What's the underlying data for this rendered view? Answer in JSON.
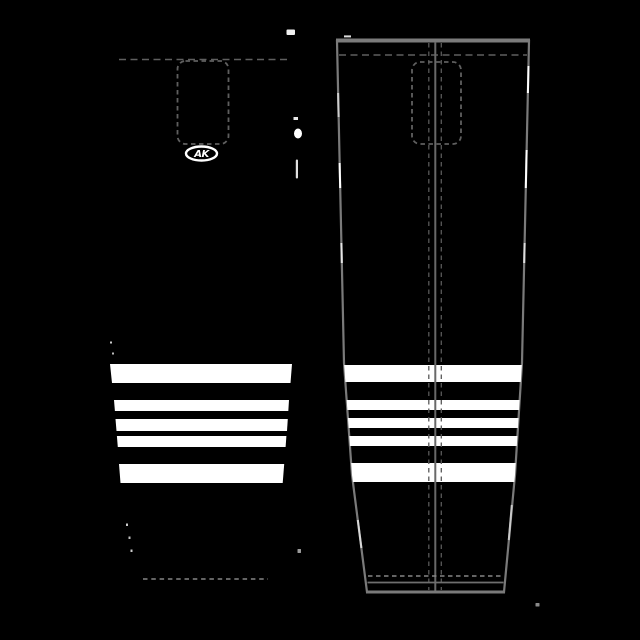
{
  "logo": {
    "text": "AK"
  },
  "colors": {
    "background": "#000000",
    "sock_fill": "#000000",
    "stripe": "#ffffff",
    "outline": "#7a7a7a",
    "top_border": "#7b7b7b",
    "solid_center": "#696969",
    "dash_dark": "#585858",
    "dash_mid": "#5f5f5f",
    "dash_light": "#868686",
    "hem_line": "#6f6f6f",
    "logo_ring": "#ffffff",
    "logo_fill": "#000000",
    "logo_text": "#ffffff"
  },
  "geometry": {
    "left_sock": {
      "body": "84,37 318,37 283.5,483 266,592 137,592 119.5,483",
      "stripes": [
        {
          "points": "110,364 292,364 290.5,383 112,383"
        },
        {
          "points": "114,400 289,400 288.3,411 114.9,411"
        },
        {
          "points": "115.5,419 287.8,419 287,431 116.5,431"
        },
        {
          "points": "116.9,436 286.4,436 285.6,447 117.8,447"
        },
        {
          "points": "119,464 284.2,464 282.7,483 120.5,483"
        }
      ],
      "top_dash_line": {
        "x1": 119,
        "y1": 59.5,
        "x2": 288,
        "y2": 59.5,
        "dash": "7,4.5",
        "w": 1.5
      },
      "bottom_dash_line": {
        "x1": 143,
        "y1": 579,
        "x2": 268,
        "y2": 579,
        "dash": "4.5,3.8",
        "w": 1.4
      },
      "pattern_rect": {
        "x": 177.5,
        "y": 61,
        "w": 51,
        "h": 83,
        "rx": 8,
        "dash": "4.5,3.5",
        "sw": 1.8
      },
      "logo": {
        "cx": 201.5,
        "cy": 153.5,
        "rx": 15.5,
        "ry": 7,
        "ring_w": 2.4,
        "font_size": 10,
        "text_dy": 3.6
      }
    },
    "right_sock": {
      "outline": "337,41 529,41 522,363 515,475 504,592 367,592 352,475 344,363",
      "outline_w": 2.2,
      "top_border": {
        "x1": 336,
        "y1": 40.5,
        "x2": 530,
        "y2": 40.5,
        "w": 4
      },
      "stripes": [
        {
          "y": 365,
          "h": 17
        },
        {
          "y": 400,
          "h": 10
        },
        {
          "y": 418,
          "h": 10
        },
        {
          "y": 436,
          "h": 10
        },
        {
          "y": 463,
          "h": 19
        }
      ],
      "stripe_span": {
        "x": 332,
        "w": 202
      },
      "top_dash_line": {
        "x1": 339,
        "y1": 55,
        "x2": 527,
        "y2": 55,
        "dash": "7,4.5",
        "w": 1.5
      },
      "pattern_rect": {
        "x": 412,
        "y": 62,
        "w": 49,
        "h": 82,
        "rx": 8,
        "dash": "4.5,3.5",
        "sw": 1.8
      },
      "center_solid": {
        "x": 435.3,
        "y1": 42,
        "y2": 591,
        "w": 2
      },
      "center_dashes": [
        428.8,
        441.3
      ],
      "center_dash_style": {
        "dash": "4.5,4",
        "w": 1.3,
        "y1": 43,
        "y2": 590
      },
      "hem_dash_line": {
        "x1": 368,
        "y1": 576,
        "x2": 502,
        "y2": 576,
        "dash": "4.5,3.5",
        "w": 1.5
      },
      "hem_solid_line": {
        "x1": 367.5,
        "y1": 582.5,
        "x2": 503.5,
        "y2": 582.5,
        "w": 1.8
      },
      "bottom_edge": {
        "x1": 366,
        "y1": 592,
        "x2": 505,
        "y2": 592,
        "w": 3
      },
      "edge_highlights": [
        {
          "x1": 338.1,
          "y1": 93,
          "x2": 338.6,
          "y2": 117,
          "c": "#cfcfcf"
        },
        {
          "x1": 339.6,
          "y1": 163,
          "x2": 340.2,
          "y2": 188,
          "c": "#ffffff"
        },
        {
          "x1": 341.4,
          "y1": 243,
          "x2": 341.8,
          "y2": 263,
          "c": "#e6e6e6"
        },
        {
          "x1": 357.8,
          "y1": 520,
          "x2": 361.4,
          "y2": 548,
          "c": "#d8d8d8"
        },
        {
          "x1": 528.5,
          "y1": 66,
          "x2": 527.9,
          "y2": 93,
          "c": "#ffffff"
        },
        {
          "x1": 526.6,
          "y1": 150,
          "x2": 525.8,
          "y2": 188,
          "c": "#ffffff"
        },
        {
          "x1": 524.6,
          "y1": 243,
          "x2": 524.2,
          "y2": 263,
          "c": "#dddddd"
        },
        {
          "x1": 511.8,
          "y1": 505,
          "x2": 508.8,
          "y2": 540,
          "c": "#c9c9c9"
        },
        {
          "x1": 344,
          "y1": 36.4,
          "x2": 351,
          "y2": 36.4,
          "c": "#dddddd"
        }
      ]
    },
    "specks": [
      {
        "type": "rect",
        "x": 286.5,
        "y": 29.5,
        "w": 8.5,
        "h": 5.5,
        "rx": 1,
        "fill": "#f0f0f0"
      },
      {
        "type": "rect",
        "x": 293.5,
        "y": 117,
        "w": 4.5,
        "h": 3,
        "rx": 0,
        "fill": "#e8e8e8"
      },
      {
        "type": "ellipse",
        "cx": 298,
        "cy": 133.5,
        "rx": 4,
        "ry": 5,
        "fill": "#ffffff"
      },
      {
        "type": "rect",
        "x": 295.8,
        "y": 159.5,
        "w": 2.2,
        "h": 19,
        "rx": 1,
        "fill": "#e0e0e0"
      },
      {
        "type": "rect",
        "x": 297.5,
        "y": 549,
        "w": 3.5,
        "h": 4,
        "rx": 0.5,
        "fill": "#9a9a9a"
      },
      {
        "type": "rect",
        "x": 535.5,
        "y": 603,
        "w": 4,
        "h": 3.5,
        "rx": 0.5,
        "fill": "#8a8a8a"
      },
      {
        "type": "rect",
        "x": 110,
        "y": 341.5,
        "w": 2,
        "h": 2,
        "rx": 0,
        "fill": "#cccccc"
      },
      {
        "type": "rect",
        "x": 112,
        "y": 352.5,
        "w": 2,
        "h": 2,
        "rx": 0,
        "fill": "#bbbbbb"
      },
      {
        "type": "rect",
        "x": 126,
        "y": 523.5,
        "w": 2,
        "h": 2.5,
        "rx": 0,
        "fill": "#cccccc"
      },
      {
        "type": "rect",
        "x": 128.5,
        "y": 536.5,
        "w": 2,
        "h": 2.5,
        "rx": 0,
        "fill": "#c0c0c0"
      },
      {
        "type": "rect",
        "x": 130.5,
        "y": 549.5,
        "w": 2,
        "h": 2.5,
        "rx": 0,
        "fill": "#cccccc"
      }
    ]
  }
}
